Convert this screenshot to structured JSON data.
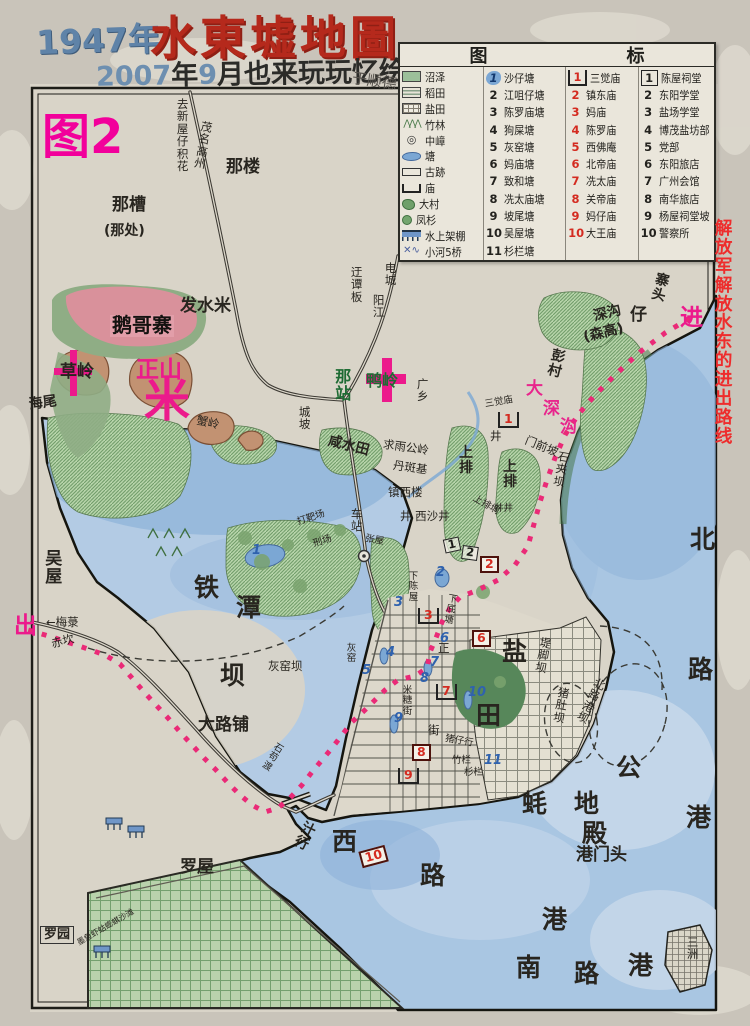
{
  "header": {
    "year": "1947年",
    "title": "水東墟地圖",
    "subtitle_parts": [
      "2007",
      "年",
      "9",
      "月也来玩玩忆绘"
    ],
    "signature": "于顺德"
  },
  "legend": {
    "header": [
      "图",
      "标"
    ],
    "symbols": [
      {
        "icon": "marsh",
        "name": "沼泽"
      },
      {
        "icon": "paddy",
        "name": "稻田"
      },
      {
        "icon": "salt",
        "name": "盐田"
      },
      {
        "icon": "bamboo",
        "name": "竹林"
      },
      {
        "icon": "hill",
        "name": "中嶂"
      },
      {
        "icon": "pond",
        "name": "塘"
      },
      {
        "icon": "ruin",
        "name": "古跡"
      },
      {
        "icon": "temple",
        "name": "庙"
      },
      {
        "icon": "village",
        "name": "大村"
      },
      {
        "icon": "fir",
        "name": "凤杉"
      },
      {
        "icon": "stilt",
        "name": "水上架棚"
      },
      {
        "icon": "river",
        "name": "小河5桥"
      }
    ],
    "ponds": [
      "沙仔塘",
      "江咀仔塘",
      "陈罗庙塘",
      "狗屎塘",
      "灰窑塘",
      "妈庙塘",
      "致和塘",
      "冼太庙塘",
      "坡尾塘",
      "吴屋塘",
      "杉栏塘"
    ],
    "temples": [
      "三觉庙",
      "镇东庙",
      "妈庙",
      "陈罗庙",
      "西佛庵",
      "北帝庙",
      "冼太庙",
      "关帝庙",
      "妈仔庙",
      "大王庙"
    ],
    "buildings": [
      "陈屋祠堂",
      "东阳学堂",
      "盐场学堂",
      "博茂盐坊部",
      "党部",
      "东阳旅店",
      "广州会馆",
      "南华旅店",
      "杨屋祠堂坡",
      "警察所"
    ]
  },
  "colors": {
    "title_red": "#b5291c",
    "title_blue": "#5f83a8",
    "magenta": "#ec1a8c",
    "route_pink": "#ea2a77",
    "note_red": "#ee2c2c",
    "water_blue": "#a9c6e2",
    "field_green": "#b7d4aa"
  },
  "map": {
    "labels": [
      {
        "t": "图2",
        "x": 42,
        "y": 112,
        "c": "fig"
      },
      {
        "t": "去新屋仔积花",
        "x": 176,
        "y": 98,
        "c": "xs",
        "v": 1
      },
      {
        "t": "茂名高州",
        "x": 201,
        "y": 120,
        "c": "xs",
        "v": 1,
        "r": 10
      },
      {
        "t": "那楼",
        "x": 226,
        "y": 158,
        "c": "lg"
      },
      {
        "t": "那槽",
        "x": 112,
        "y": 196,
        "c": "lg"
      },
      {
        "t": "(那处)",
        "x": 104,
        "y": 224,
        "c": "md"
      },
      {
        "t": "发水米",
        "x": 180,
        "y": 297,
        "c": "lg"
      },
      {
        "t": "鹅哥寨",
        "x": 110,
        "y": 315,
        "c": "pink-label"
      },
      {
        "t": "草岭",
        "x": 60,
        "y": 363,
        "c": "lg"
      },
      {
        "t": "正山",
        "x": 136,
        "y": 358,
        "c": "mag-lg"
      },
      {
        "t": "米",
        "x": 144,
        "y": 376,
        "c": "star"
      },
      {
        "t": "海尾",
        "x": 28,
        "y": 398,
        "c": "md",
        "r": -8
      },
      {
        "t": "蟹岭",
        "x": 198,
        "y": 414,
        "c": "xs",
        "r": 12
      },
      {
        "t": "城坡",
        "x": 298,
        "y": 406,
        "c": "xs",
        "v": 1
      },
      {
        "t": "迂谭板",
        "x": 350,
        "y": 266,
        "c": "xs",
        "v": 1
      },
      {
        "t": "电城",
        "x": 384,
        "y": 262,
        "c": "xs",
        "v": 1
      },
      {
        "t": "阳江",
        "x": 372,
        "y": 294,
        "c": "xs",
        "v": 1
      },
      {
        "t": "那站",
        "x": 334,
        "y": 368,
        "c": "grn",
        "v": 1
      },
      {
        "t": "鸭岭",
        "x": 366,
        "y": 372,
        "c": "grn"
      },
      {
        "t": "广乡",
        "x": 416,
        "y": 378,
        "c": "xs",
        "v": 1
      },
      {
        "t": "咸水田",
        "x": 330,
        "y": 434,
        "c": "md",
        "r": 14
      },
      {
        "t": "求雨公岭",
        "x": 384,
        "y": 438,
        "c": "xs",
        "r": 8
      },
      {
        "t": "丹斑基",
        "x": 394,
        "y": 459,
        "c": "xs",
        "r": 8
      },
      {
        "t": "三觉庙",
        "x": 484,
        "y": 400,
        "c": "xxs",
        "r": -10
      },
      {
        "t": "井",
        "x": 490,
        "y": 430,
        "c": "xs"
      },
      {
        "t": "大",
        "x": 526,
        "y": 380,
        "c": "mag-md"
      },
      {
        "t": "深",
        "x": 543,
        "y": 400,
        "c": "mag-md"
      },
      {
        "t": "沟",
        "x": 560,
        "y": 418,
        "c": "mag-md"
      },
      {
        "t": "门前坡",
        "x": 528,
        "y": 434,
        "c": "xs",
        "r": 22
      },
      {
        "t": "彭村",
        "x": 552,
        "y": 348,
        "c": "md",
        "v": 1,
        "r": 14
      },
      {
        "t": "深沟",
        "x": 592,
        "y": 310,
        "c": "md",
        "r": -14
      },
      {
        "t": "仔",
        "x": 630,
        "y": 306,
        "c": "bold-md"
      },
      {
        "t": "(森高)",
        "x": 582,
        "y": 331,
        "c": "md",
        "r": -14
      },
      {
        "t": "寨头",
        "x": 656,
        "y": 272,
        "c": "md",
        "v": 1,
        "r": 14
      },
      {
        "t": "进",
        "x": 680,
        "y": 306,
        "c": "mag-lg"
      },
      {
        "t": "石夹坝",
        "x": 558,
        "y": 450,
        "c": "xs",
        "v": 1,
        "r": 10
      },
      {
        "t": "上排",
        "x": 458,
        "y": 446,
        "c": "md",
        "v": 1
      },
      {
        "t": "上排",
        "x": 502,
        "y": 460,
        "c": "md",
        "v": 1
      },
      {
        "t": "上排垌",
        "x": 476,
        "y": 494,
        "c": "xxs",
        "r": 30
      },
      {
        "t": "井井",
        "x": 494,
        "y": 504,
        "c": "xxs"
      },
      {
        "t": "镇西楼",
        "x": 388,
        "y": 486,
        "c": "xs"
      },
      {
        "t": "井 西沙井",
        "x": 400,
        "y": 510,
        "c": "xs"
      },
      {
        "t": "车站",
        "x": 350,
        "y": 508,
        "c": "xs",
        "v": 1
      },
      {
        "t": "张屋",
        "x": 366,
        "y": 534,
        "c": "xxs",
        "r": 10
      },
      {
        "t": "打靶场",
        "x": 296,
        "y": 518,
        "c": "xxs",
        "r": -18
      },
      {
        "t": "刑场",
        "x": 312,
        "y": 540,
        "c": "xxs",
        "r": -18
      },
      {
        "t": "下陈屋",
        "x": 408,
        "y": 572,
        "c": "xxs",
        "v": 1
      },
      {
        "t": "下底塘",
        "x": 448,
        "y": 594,
        "c": "xxs",
        "v": 1,
        "r": 10
      },
      {
        "t": "吴屋",
        "x": 44,
        "y": 550,
        "c": "lg",
        "v": 1
      },
      {
        "t": "铁",
        "x": 194,
        "y": 574,
        "c": "huge"
      },
      {
        "t": "潭",
        "x": 236,
        "y": 594,
        "c": "huge"
      },
      {
        "t": "坝",
        "x": 220,
        "y": 662,
        "c": "huge"
      },
      {
        "t": "灰窑坝",
        "x": 268,
        "y": 660,
        "c": "xs"
      },
      {
        "t": "灰窑",
        "x": 346,
        "y": 644,
        "c": "xxs",
        "v": 1
      },
      {
        "t": "大路铺",
        "x": 198,
        "y": 716,
        "c": "lg"
      },
      {
        "t": "出",
        "x": 14,
        "y": 614,
        "c": "mag-lg"
      },
      {
        "t": "←梅菉",
        "x": 46,
        "y": 616,
        "c": "xs"
      },
      {
        "t": "赤坎",
        "x": 50,
        "y": 638,
        "c": "xs",
        "r": -14
      },
      {
        "t": "正",
        "x": 438,
        "y": 642,
        "c": "xs"
      },
      {
        "t": "米糖街",
        "x": 402,
        "y": 686,
        "c": "xxs",
        "v": 1
      },
      {
        "t": "街",
        "x": 428,
        "y": 724,
        "c": "xs"
      },
      {
        "t": "猪仔行",
        "x": 446,
        "y": 734,
        "c": "xxs",
        "r": 10
      },
      {
        "t": "竹栏",
        "x": 452,
        "y": 756,
        "c": "xxs"
      },
      {
        "t": "杉栏",
        "x": 464,
        "y": 768,
        "c": "xxs"
      },
      {
        "t": "盐",
        "x": 502,
        "y": 638,
        "c": "huge"
      },
      {
        "t": "田",
        "x": 476,
        "y": 702,
        "c": "huge"
      },
      {
        "t": "堤脚坝",
        "x": 540,
        "y": 636,
        "c": "xs",
        "v": 1,
        "r": 10
      },
      {
        "t": "猪肚坝",
        "x": 558,
        "y": 686,
        "c": "xs",
        "v": 1,
        "r": 10
      },
      {
        "t": "北路港坝",
        "x": 596,
        "y": 676,
        "c": "xs",
        "v": 1,
        "r": 26
      },
      {
        "t": "蚝",
        "x": 522,
        "y": 790,
        "c": "huge"
      },
      {
        "t": "地",
        "x": 574,
        "y": 790,
        "c": "huge"
      },
      {
        "t": "殿",
        "x": 582,
        "y": 820,
        "c": "huge"
      },
      {
        "t": "港门头",
        "x": 576,
        "y": 846,
        "c": "lg"
      },
      {
        "t": "港",
        "x": 542,
        "y": 906,
        "c": "huge"
      },
      {
        "t": "南",
        "x": 516,
        "y": 954,
        "c": "huge"
      },
      {
        "t": "路",
        "x": 574,
        "y": 960,
        "c": "huge"
      },
      {
        "t": "港",
        "x": 628,
        "y": 952,
        "c": "huge"
      },
      {
        "t": "北",
        "x": 690,
        "y": 526,
        "c": "huge"
      },
      {
        "t": "路",
        "x": 688,
        "y": 656,
        "c": "huge"
      },
      {
        "t": "港",
        "x": 686,
        "y": 804,
        "c": "huge"
      },
      {
        "t": "公",
        "x": 616,
        "y": 754,
        "c": "huge"
      },
      {
        "t": "三洲",
        "x": 686,
        "y": 936,
        "c": "xs",
        "v": 1
      },
      {
        "t": "西",
        "x": 332,
        "y": 828,
        "c": "huge"
      },
      {
        "t": "路",
        "x": 420,
        "y": 862,
        "c": "huge"
      },
      {
        "t": "汁行",
        "x": 304,
        "y": 820,
        "c": "md",
        "v": 1,
        "r": 26
      },
      {
        "t": "石苟渡",
        "x": 276,
        "y": 742,
        "c": "xxs",
        "v": 1,
        "r": 32
      },
      {
        "t": "罗屋",
        "x": 180,
        "y": 858,
        "c": "lg"
      },
      {
        "t": "罗园",
        "x": 40,
        "y": 926,
        "c": "boxed"
      },
      {
        "t": "墨鱼虾蛄蟛蜞沙滩",
        "x": 76,
        "y": 940,
        "c": "tiny",
        "r": -30
      },
      {
        "t": "解放军解放水东的进出路线",
        "x": 714,
        "y": 220,
        "c": "rednote",
        "v": 1
      }
    ],
    "pond_markers": [
      {
        "n": 1,
        "x": 252,
        "y": 544
      },
      {
        "n": 2,
        "x": 436,
        "y": 566
      },
      {
        "n": 3,
        "x": 394,
        "y": 596
      },
      {
        "n": 4,
        "x": 386,
        "y": 646
      },
      {
        "n": 5,
        "x": 362,
        "y": 664
      },
      {
        "n": 6,
        "x": 440,
        "y": 632
      },
      {
        "n": 7,
        "x": 430,
        "y": 656
      },
      {
        "n": 8,
        "x": 420,
        "y": 672
      },
      {
        "n": 9,
        "x": 394,
        "y": 712
      },
      {
        "n": 10,
        "x": 468,
        "y": 686
      },
      {
        "n": 11,
        "x": 484,
        "y": 754
      }
    ],
    "temple_markers": [
      {
        "n": 1,
        "x": 498,
        "y": 412,
        "s": "gate"
      },
      {
        "n": 2,
        "x": 480,
        "y": 556,
        "s": "box"
      },
      {
        "n": 3,
        "x": 418,
        "y": 608,
        "s": "gate"
      },
      {
        "n": 6,
        "x": 472,
        "y": 630,
        "s": "box"
      },
      {
        "n": 7,
        "x": 436,
        "y": 684,
        "s": "gate"
      },
      {
        "n": 8,
        "x": 412,
        "y": 744,
        "s": "box"
      },
      {
        "n": 9,
        "x": 398,
        "y": 768,
        "s": "gate"
      },
      {
        "n": 10,
        "x": 360,
        "y": 848,
        "s": "box",
        "r": -15
      }
    ],
    "building_markers": [
      {
        "n": 1,
        "x": 444,
        "y": 538,
        "r": -12
      },
      {
        "n": 2,
        "x": 462,
        "y": 546,
        "r": 8
      }
    ]
  }
}
